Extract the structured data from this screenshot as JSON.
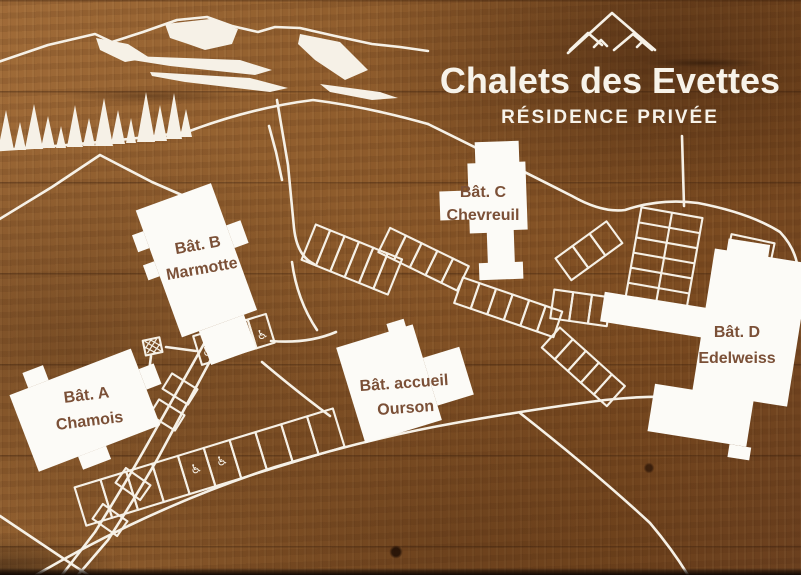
{
  "sign": {
    "title": "Chalets des Evettes",
    "subtitle": "RÉSIDENCE PRIVÉE",
    "logo": "three-mountain-peaks"
  },
  "buildings": [
    {
      "id": "chamois",
      "line1": "Bât. A",
      "line2": "Chamois"
    },
    {
      "id": "marmotte",
      "line1": "Bât. B",
      "line2": "Marmotte"
    },
    {
      "id": "chevreuil",
      "line1": "Bât. C",
      "line2": "Chevreuil"
    },
    {
      "id": "edelweiss",
      "line1": "Bât. D",
      "line2": "Edelweiss"
    },
    {
      "id": "ourson",
      "line1": "Bât. accueil",
      "line2": "Ourson"
    }
  ],
  "icons": {
    "accessible_parking": "♿",
    "mountain_logo": "mountain-peaks-icon",
    "scenery": [
      "mountain-ridge",
      "snow-patches",
      "pine-trees"
    ]
  },
  "colors": {
    "wood_base": "#8a5a2c",
    "line_white": "#f6f1e7",
    "building_fill": "#fcfbf7",
    "label_text": "#7b5037"
  }
}
